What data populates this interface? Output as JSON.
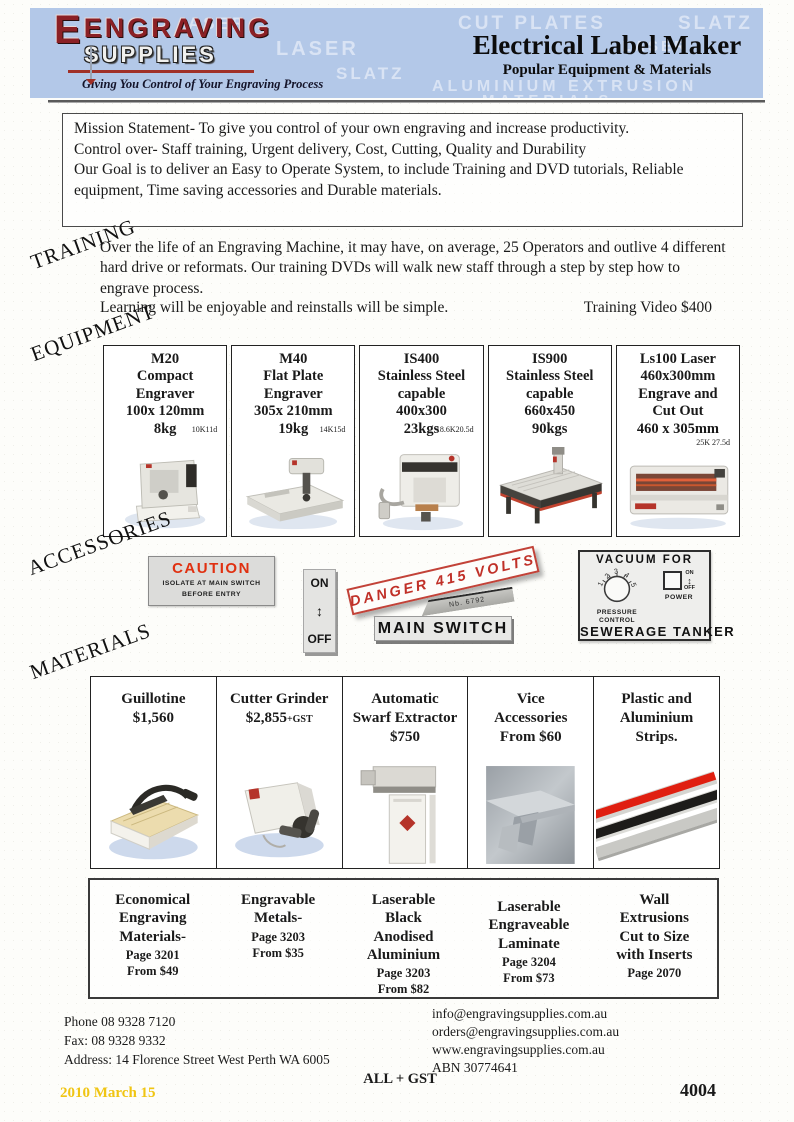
{
  "colors": {
    "banner_blue": "#b3c8e8",
    "logo_red": "#8b2025",
    "caution_red": "#e03010",
    "danger_red": "#c03028",
    "accent_red": "#b5342a",
    "date_yellow": "#f0c513"
  },
  "header": {
    "logo_line1": "ENGRAVING",
    "logo_line2": "SUPPLIES",
    "tagline": "Giving You Control  of  Your Engraving Process",
    "title": "Electrical Label Maker",
    "subtitle": "Popular Equipment & Materials",
    "watermarks": [
      "ASER",
      "LASER",
      "SLATZ",
      "CUT PLATES",
      "SLATZ",
      "LASER",
      "ALUMINIUM EXTRUSION",
      "MATERIALS"
    ]
  },
  "mission": {
    "text": "Mission Statement- To give you control of your own engraving and increase productivity.\nControl over- Staff training, Urgent delivery, Cost, Cutting, Quality and Durability\nOur Goal is to deliver an Easy to Operate System, to include Training and DVD tutorials, Reliable\nequipment, Time saving accessories and Durable materials."
  },
  "training": {
    "section_label": "TRAINING",
    "body": "Over the life of an Engraving Machine, it may have, on average, 25 Operators and outlive 4 different\nhard drive or reformats. Our training DVDs will walk new staff  through a step by step how to\nengrave process.",
    "tagline": "Learning will be enjoyable and reinstalls will be simple.",
    "video_price": "Training Video $400"
  },
  "equipment": {
    "section_label": "EQUIPMENT",
    "products": [
      {
        "title": "M20\nCompact\nEngraver\n100x 120mm\n8kg",
        "code": "10K11d"
      },
      {
        "title": "M40\nFlat Plate\nEngraver\n305x 210mm\n19kg",
        "code": "14K15d"
      },
      {
        "title": "IS400\nStainless Steel\ncapable\n400x300\n23kgs",
        "code": "18.6K20.5d"
      },
      {
        "title": "IS900\nStainless Steel\ncapable\n660x450\n90kgs",
        "code": ""
      },
      {
        "title": "Ls100 Laser\n460x300mm\nEngrave and\nCut Out\n460 x 305mm",
        "code": "25K 27.5d"
      }
    ]
  },
  "accessories": {
    "section_label": "ACCESSORIES",
    "caution": {
      "title": "CAUTION",
      "body": "ISOLATE  AT  MAIN  SWITCH\nBEFORE  ENTRY"
    },
    "onoff": {
      "on": "ON",
      "arrow": "↕",
      "off": "OFF"
    },
    "danger": "DANGER  415  VOLTS",
    "tag": "Nb.  6792",
    "main_switch": "MAIN  SWITCH",
    "vacuum": {
      "title": "VACUUM  FOR",
      "dial_numbers": [
        "1",
        "2",
        "3",
        "4",
        "5"
      ],
      "dial_label": "PRESSURE\nCONTROL",
      "power_label": "POWER",
      "on": "ON",
      "arrow": "↕",
      "off": "OFF",
      "bottom": "SEWERAGE  TANKER"
    }
  },
  "materials": {
    "section_label": "MATERIALS",
    "products": [
      {
        "title": "Guillotine\n$1,560"
      },
      {
        "name": "Cutter Grinder",
        "price": "$2,855",
        "suffix": "+GST"
      },
      {
        "title": "Automatic\nSwarf Extractor\n$750"
      },
      {
        "title": "Vice\nAccessories\nFrom $60"
      },
      {
        "title": "Plastic and\nAluminium\nStrips."
      }
    ]
  },
  "catalog": {
    "items": [
      {
        "title": "Economical\nEngraving\nMaterials-",
        "sub": "Page 3201\nFrom $49"
      },
      {
        "title": "Engravable\nMetals-",
        "sub": "Page 3203\nFrom $35"
      },
      {
        "title": "Laserable\nBlack\nAnodised\nAluminium",
        "sub": "Page 3203\nFrom $82"
      },
      {
        "title": "Laserable\nEngraveable\nLaminate",
        "sub": "Page 3204\nFrom $73"
      },
      {
        "title": "Wall\nExtrusions\nCut to Size\nwith Inserts",
        "sub": "Page 2070"
      }
    ]
  },
  "footer": {
    "contact_left": "Phone 08 9328 7120\nFax: 08 9328 9332\nAddress: 14 Florence Street West Perth WA 6005",
    "contact_right": "info@engravingsupplies.com.au\norders@engravingsupplies.com.au\nwww.engravingsupplies.com.au\nABN 30774641",
    "gst_note": "ALL + GST",
    "date": "2010 March 15",
    "page_number": "4004"
  }
}
